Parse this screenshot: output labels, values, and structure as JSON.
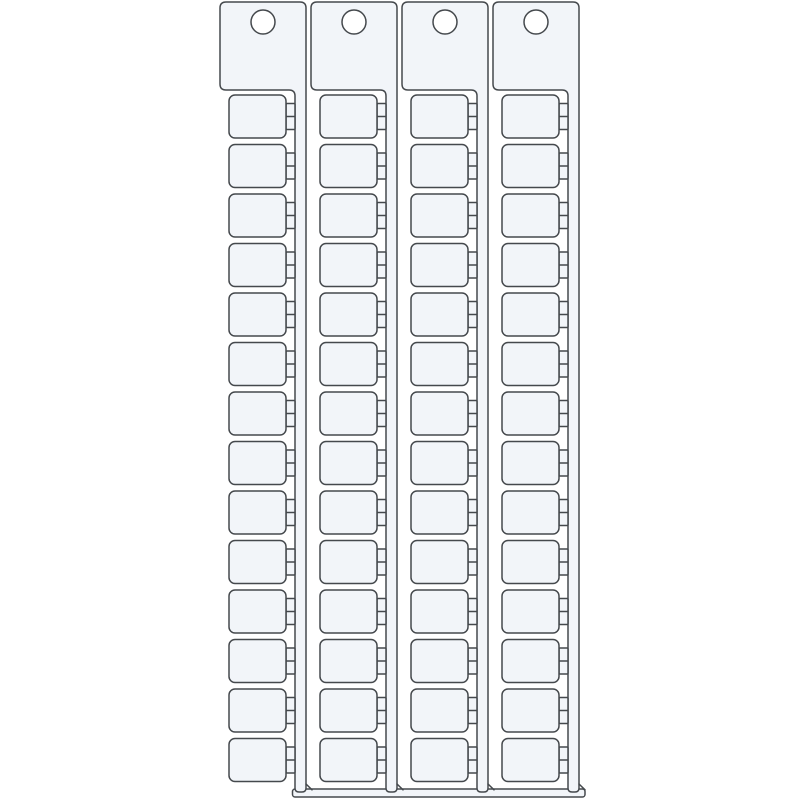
{
  "page": {
    "background": "#ffffff"
  },
  "drawing": {
    "kind": "product-line-drawing",
    "object": "terminal-block-marker-card",
    "strip_count": 4,
    "markers_per_strip": 14,
    "holes_per_strip": 1,
    "colors": {
      "fill": "#f2f5f9",
      "stroke": "#45494d",
      "hole_fill": "#ffffff",
      "background": "#ffffff"
    },
    "stroke_width": 1.5
  }
}
